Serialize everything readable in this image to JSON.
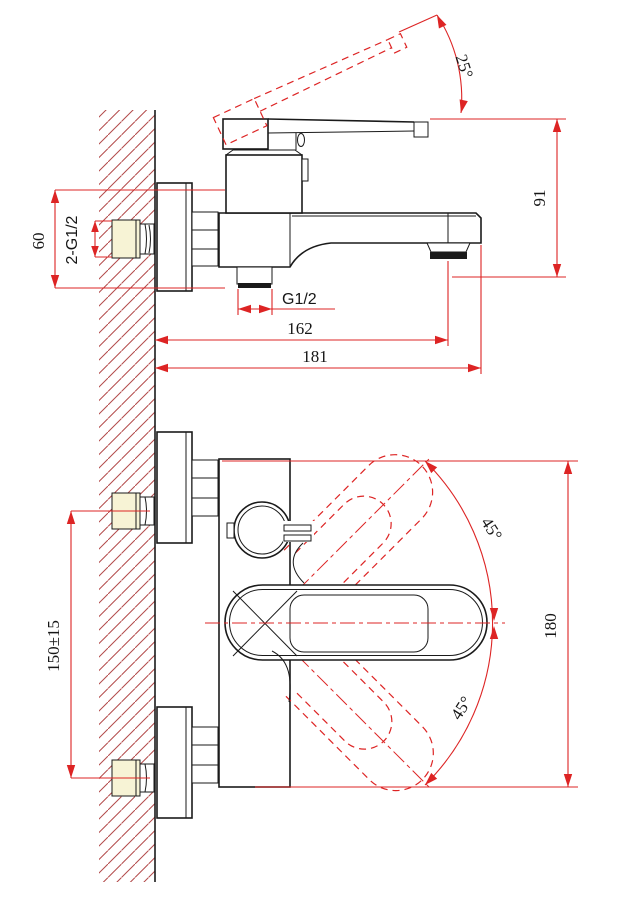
{
  "drawing": {
    "side_view": {
      "dims": {
        "handle_angle": "25°",
        "height": "91",
        "escutcheon": "60",
        "wall_unions": "2-G1/2",
        "outlet_thread": "G1/2",
        "spout_reach": "162",
        "overall_depth": "181"
      }
    },
    "plan_view": {
      "dims": {
        "swing_up": "45°",
        "swing_down": "45°",
        "span": "180",
        "inlet_spacing": "150±15"
      }
    }
  },
  "colors": {
    "dim": "#dd2424",
    "hatch": "#b24a4a",
    "ink": "#1a1a1a",
    "cap": "#f7f3d5"
  }
}
